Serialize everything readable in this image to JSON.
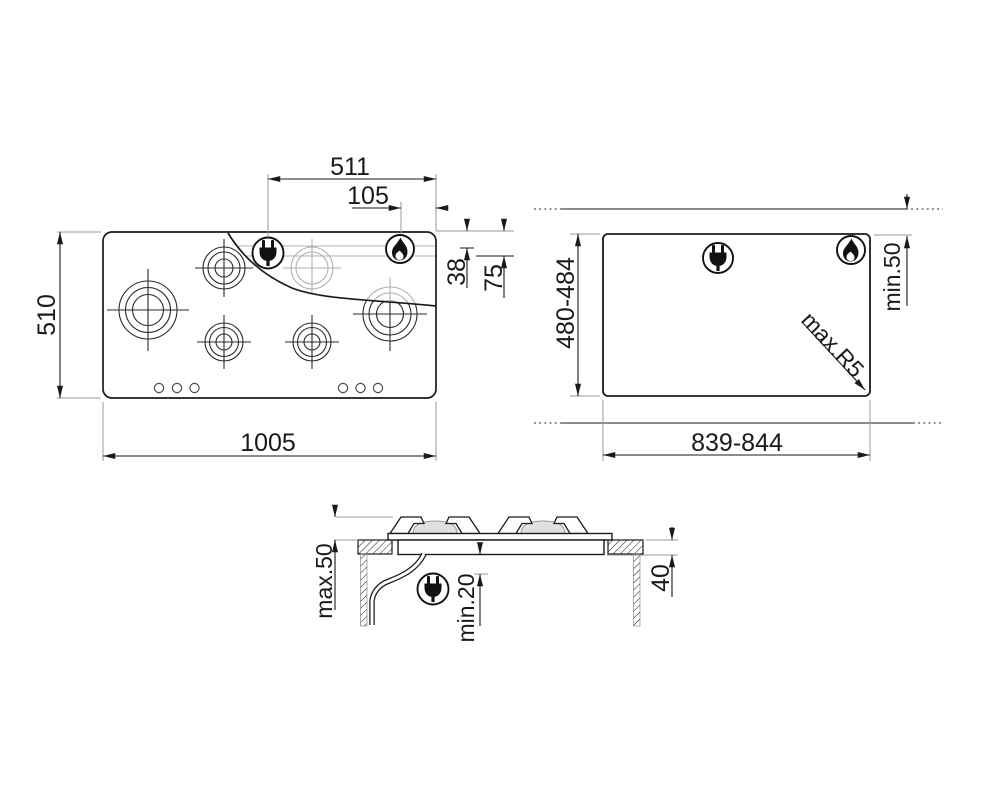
{
  "colors": {
    "line": "#1a1a1a",
    "ghost": "#b0b0b0",
    "background": "#ffffff",
    "burner_cap_fill": "#e0e0e0"
  },
  "icons": {
    "plug": "power-plug-icon",
    "flame": "gas-flame-icon"
  },
  "top_view": {
    "width": "1005",
    "depth": "510",
    "plug_offset": "511",
    "gas_offset": "105",
    "gas_inset": "38",
    "plug_inset": "75"
  },
  "cutout_view": {
    "width": "839-844",
    "depth": "480-484",
    "edge_clearance": "min.50",
    "corner_radius": "max.R5"
  },
  "section_view": {
    "max_height_above": "max.50",
    "min_clearance_below": "min.20",
    "recess_depth": "40"
  }
}
